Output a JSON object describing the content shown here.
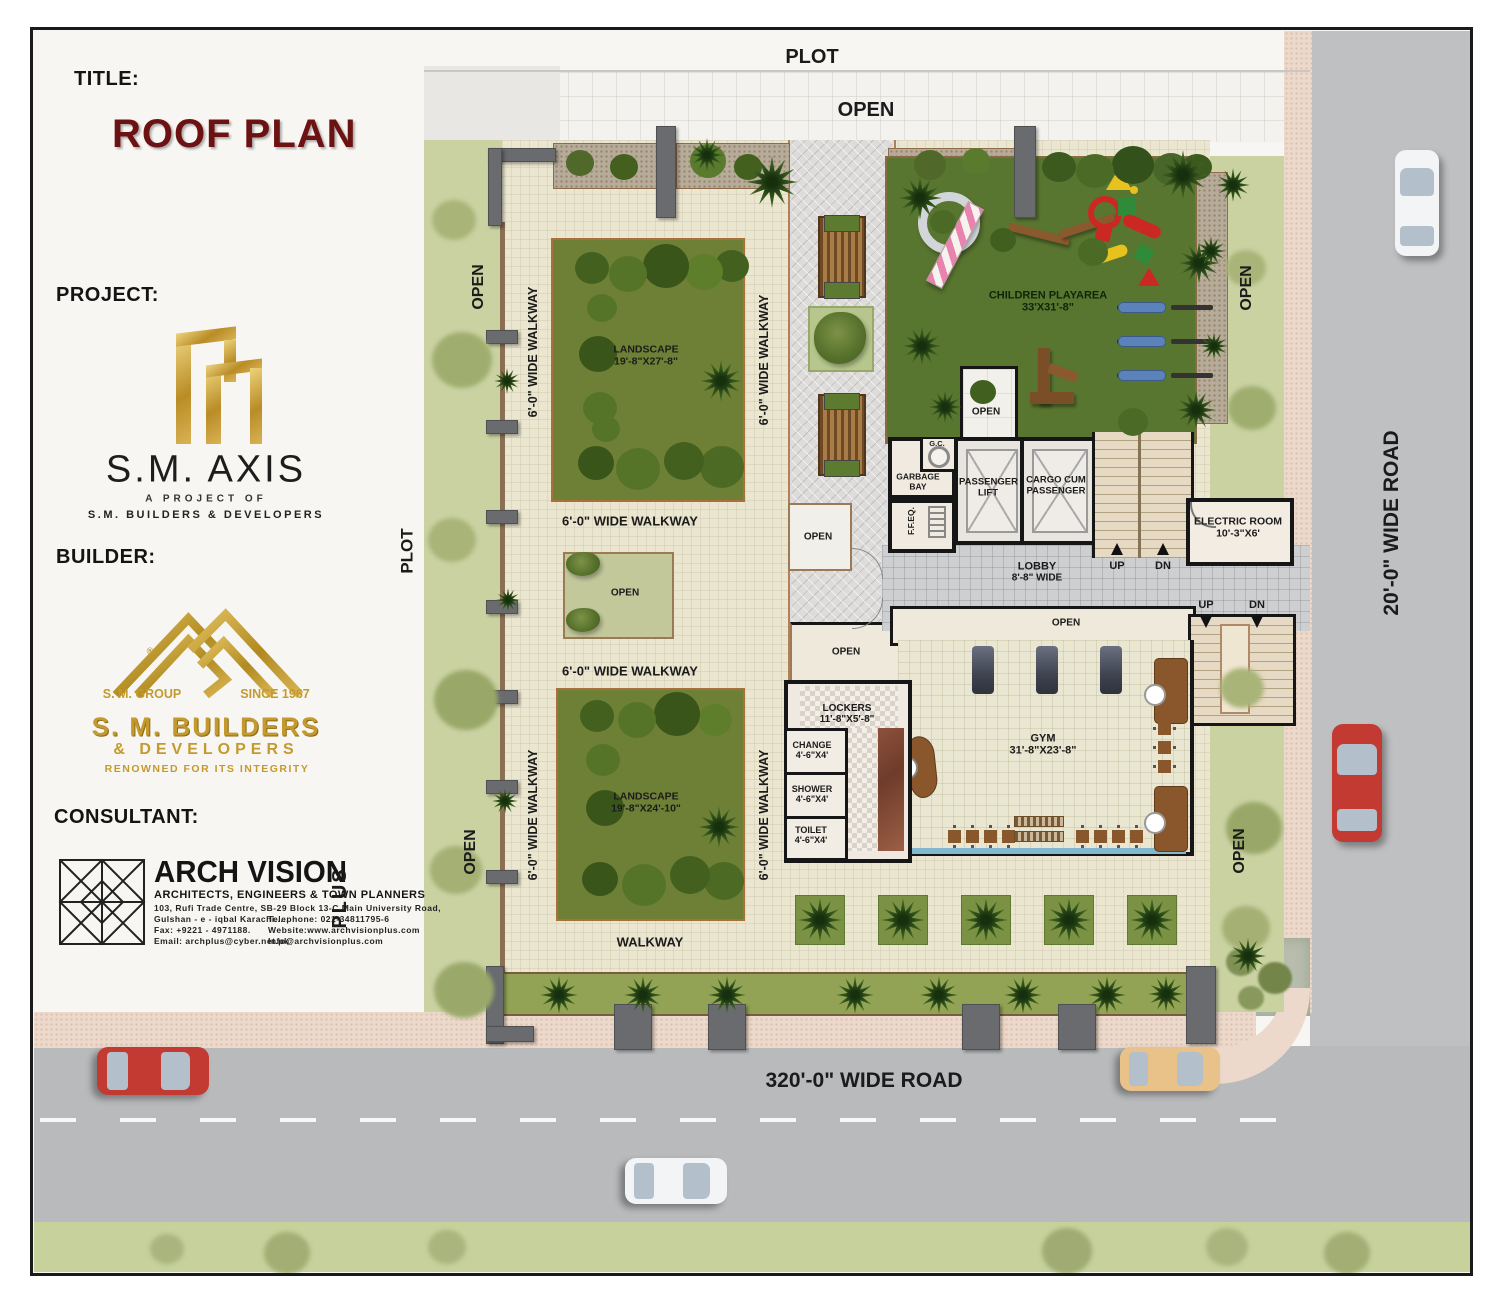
{
  "title_block": {
    "title_label": "TITLE:",
    "title": "ROOF PLAN",
    "project_label": "PROJECT:",
    "project_name": "S.M. AXIS",
    "project_sub1": "A PROJECT OF",
    "project_sub2": "S.M. BUILDERS & DEVELOPERS",
    "builder_label": "BUILDER:",
    "builder": {
      "group": "S. M. GROUP",
      "since": "SINCE 1967",
      "reg": "®",
      "name1": "S. M. BUILDERS",
      "name2": "& DEVELOPERS",
      "tagline": "RENOWNED FOR ITS INTEGRITY"
    },
    "consultant_label": "CONSULTANT:",
    "consultant": {
      "name": "ARCH VISION",
      "plus": "PLUS",
      "profession": "ARCHITECTS, ENGINEERS & TOWN PLANNERS",
      "address1": "103, Rufi Trade Centre, SB-29 Block 13-C Main University Road,",
      "address2": "Gulshan - e - iqbal Karachi.....",
      "telephone": "Telephone: 021-34811795-6",
      "fax": "Fax: +9221 - 4971188.",
      "website": "Website:www.archvisionplus.com",
      "email": "Email: archplus@cyber.net.pk",
      "email2": "Info@archvisionplus.com"
    }
  },
  "plan": {
    "plot": "PLOT",
    "open": "OPEN",
    "walkway6": "6'-0\" WIDE WALKWAY",
    "walkway": "WALKWAY",
    "landscape1": {
      "name": "LANDSCAPE",
      "size": "19'-8\"X27'-8\""
    },
    "landscape2": {
      "name": "LANDSCAPE",
      "size": "19'-8\"X24'-10\""
    },
    "children": {
      "name": "CHILDREN PLAYAREA",
      "size": "33'X31'-8\""
    },
    "gym": {
      "name": "GYM",
      "size": "31'-8\"X23'-8\""
    },
    "lockers": {
      "name": "LOCKERS",
      "size": "11'-8\"X5'-8\""
    },
    "change": {
      "name": "CHANGE",
      "size": "4'-6\"X4'"
    },
    "shower": {
      "name": "SHOWER",
      "size": "4'-6\"X4'"
    },
    "toilet": {
      "name": "TOILET",
      "size": "4'-6\"X4'"
    },
    "electric": {
      "name": "ELECTRIC ROOM",
      "size": "10'-3\"X6'"
    },
    "lobby": {
      "name": "LOBBY",
      "size": "8'-8\" WIDE"
    },
    "garbage_bay": "GARBAGE BAY",
    "gc": "G.C.",
    "ffeq": "F.F.EQ.",
    "passenger_lift": "PASSENGER LIFT",
    "cargo_lift": "CARGO CUM PASSENGER",
    "up": "UP",
    "dn": "DN",
    "road_right": "20'-0\" WIDE ROAD",
    "road_bottom": "320'-0\" WIDE ROAD"
  },
  "colors": {
    "title_maroon": "#6d1212",
    "gold": "#c49a2e",
    "deck_tile": "#ebe6d0",
    "lawn_pale": "#cad2a2",
    "landscape_green": "#6d8036",
    "play_lawn": "#597630",
    "road_gray": "#b9babc",
    "sidewalk_pink": "#ecd9cb",
    "wall_dark": "#161616",
    "pool_blue": "#82b8ce"
  }
}
